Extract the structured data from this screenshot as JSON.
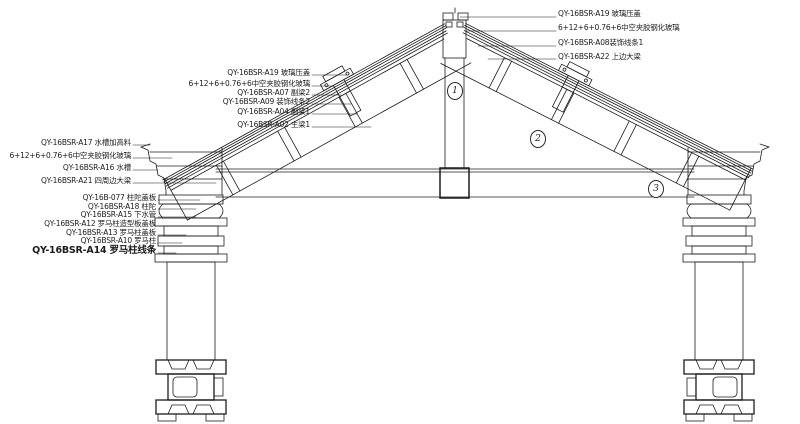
{
  "drawing_type": "roof-glazing-and-roman-column-construction-detail",
  "colors": {
    "line": "#1c1c1c",
    "background": "#ffffff"
  },
  "callouts": {
    "top_right": [
      "QY-16BSR-A19 玻璃压盖",
      "6+12+6+0.76+6中空夹胶钢化玻璃",
      "QY-16BSR-A08装饰线条1",
      "QY-16BSR-A22 上边大梁"
    ],
    "mid_left": [
      "QY-16BSR-A19 玻璃压盖",
      "6+12+6+0.76+6中空夹胶钢化玻璃",
      "QY-16BSR-A07 副梁2",
      "QY-16BSR-A09 装饰线条2",
      "QY-16BSR-A04 副梁1",
      "QY-16BSR-A02 主梁1"
    ],
    "left": [
      "QY-16BSR-A17 水槽加高料",
      "6+12+6+0.76+6中空夹胶钢化玻璃",
      "QY-16BSR-A16 水槽",
      "QY-16BSR-A21 四周边大梁"
    ],
    "lower_left": [
      "QY-16B-077 柱陀盖板",
      "QY-16BSR-A18 柱陀",
      "QY-16BSR-A15 下水管",
      "QY-16BSR-A12 罗马柱造型板盖板",
      "QY-16BSR-A13 罗马柱盖板",
      "QY-16BSR-A10 罗马柱",
      "QY-16BSR-A14 罗马柱线条"
    ]
  },
  "markers": [
    "1",
    "2",
    "3"
  ]
}
